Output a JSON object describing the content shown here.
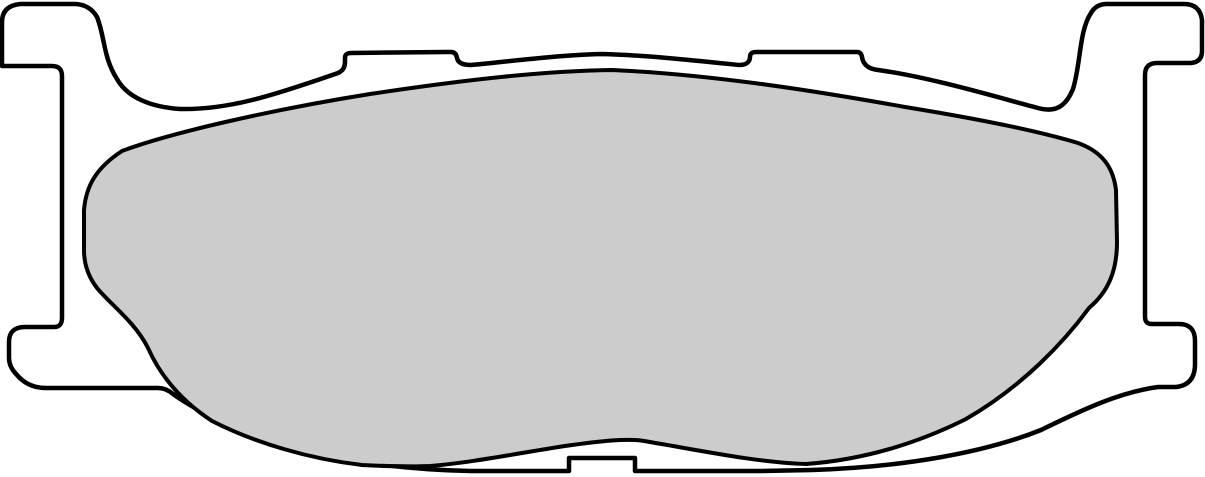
{
  "page": {
    "background": "#ffffff",
    "description": "Technical outline drawing of a disc brake pad: metal backing plate profile with mounting ears, top tabs, bottom feet, bottom locating notch, and gray friction material surface."
  },
  "diagram": {
    "type": "technical-outline-drawing",
    "subject": "brake-pad-profile",
    "canvas": {
      "width": 1205,
      "height": 477,
      "viewbox": "0 0 1205 477",
      "background": "#ffffff"
    },
    "backing_plate": {
      "label": "backing plate outline",
      "fill": "#ffffff",
      "stroke": "#000000",
      "stroke_width": 4.5,
      "features": [
        "hooked-ear-top-left",
        "raised-tab-top-center-left",
        "raised-tab-top-center-right",
        "hooked-ear-top-right",
        "stepped-foot-bottom-right",
        "rectangular-notch-bottom-center",
        "stepped-foot-bottom-left"
      ],
      "path": "M 2 66 L 2 22 Q 2 6 20 4 L 76 4 Q 90 5 97 17 C 105 37 103 57 117 79 C 127 97 150 107 180 109 C 228 110 272 96 338 73 Q 345 70 345 62 L 345 58 Q 345 53 351 53 L 446 52 L 451 52 Q 456 52 457 58 C 458 63 463 65 471 65 C 512 61 560 55 602 54 C 645 55 700 61 739 65 C 746 65 750 62 750 57 Q 750 52 756 52 L 852 52 L 857 52 Q 861 52 862 57 C 863 64 868 69 878 70 C 930 77 1000 98 1038 108 C 1056 113 1066 106 1073 89 C 1081 63 1079 31 1091 13 Q 1096 4 1107 4 L 1184 4 Q 1200 4 1202 20 L 1202 51 Q 1202 62 1191 63 L 1157 63 Q 1145 63 1145 75 L 1145 317 Q 1145 324 1152 324 L 1179 324 Q 1195 324 1195 341 L 1195 364 Q 1195 385 1176 387 L 1158 387 C 1121 392 1086 408 1041 430 C 986 452 906 467 812 470 L 760 471 L 635 471 L 635 458 L 569 458 L 569 471 L 470 471 C 416 470 351 463 299 450 C 249 436 201 414 173 394 Q 166 388 158 388 L 46 388 Q 28 388 17 375 Q 9 367 9 358 L 9 342 Q 9 327 25 327 L 54 327 Q 62 327 62 318 L 62 76 Q 62 66 52 66 Z"
    },
    "friction_material": {
      "label": "friction material pad surface",
      "fill": "#cccccc",
      "stroke": "#000000",
      "stroke_width": 4,
      "path": "M 84 210 C 86 186 96 168 122 151 C 170 133 270 110 370 94 C 470 79 545 71 612 70 C 705 74 805 89 905 107 C 985 120 1045 133 1078 143 C 1100 151 1113 165 1116 190 L 1117 242 C 1117 270 1109 291 1089 308 C 1064 342 1023 386 966 419 C 912 446 860 460 806 464 C 760 463 698 450 644 441 C 628 438 600 441 565 446 C 525 452 470 463 430 466 C 405 467 382 466 362 465 C 310 459 255 443 212 421 C 180 400 160 375 148 348 C 135 322 110 304 97 288 C 87 275 84 262 84 250 Z"
    }
  }
}
